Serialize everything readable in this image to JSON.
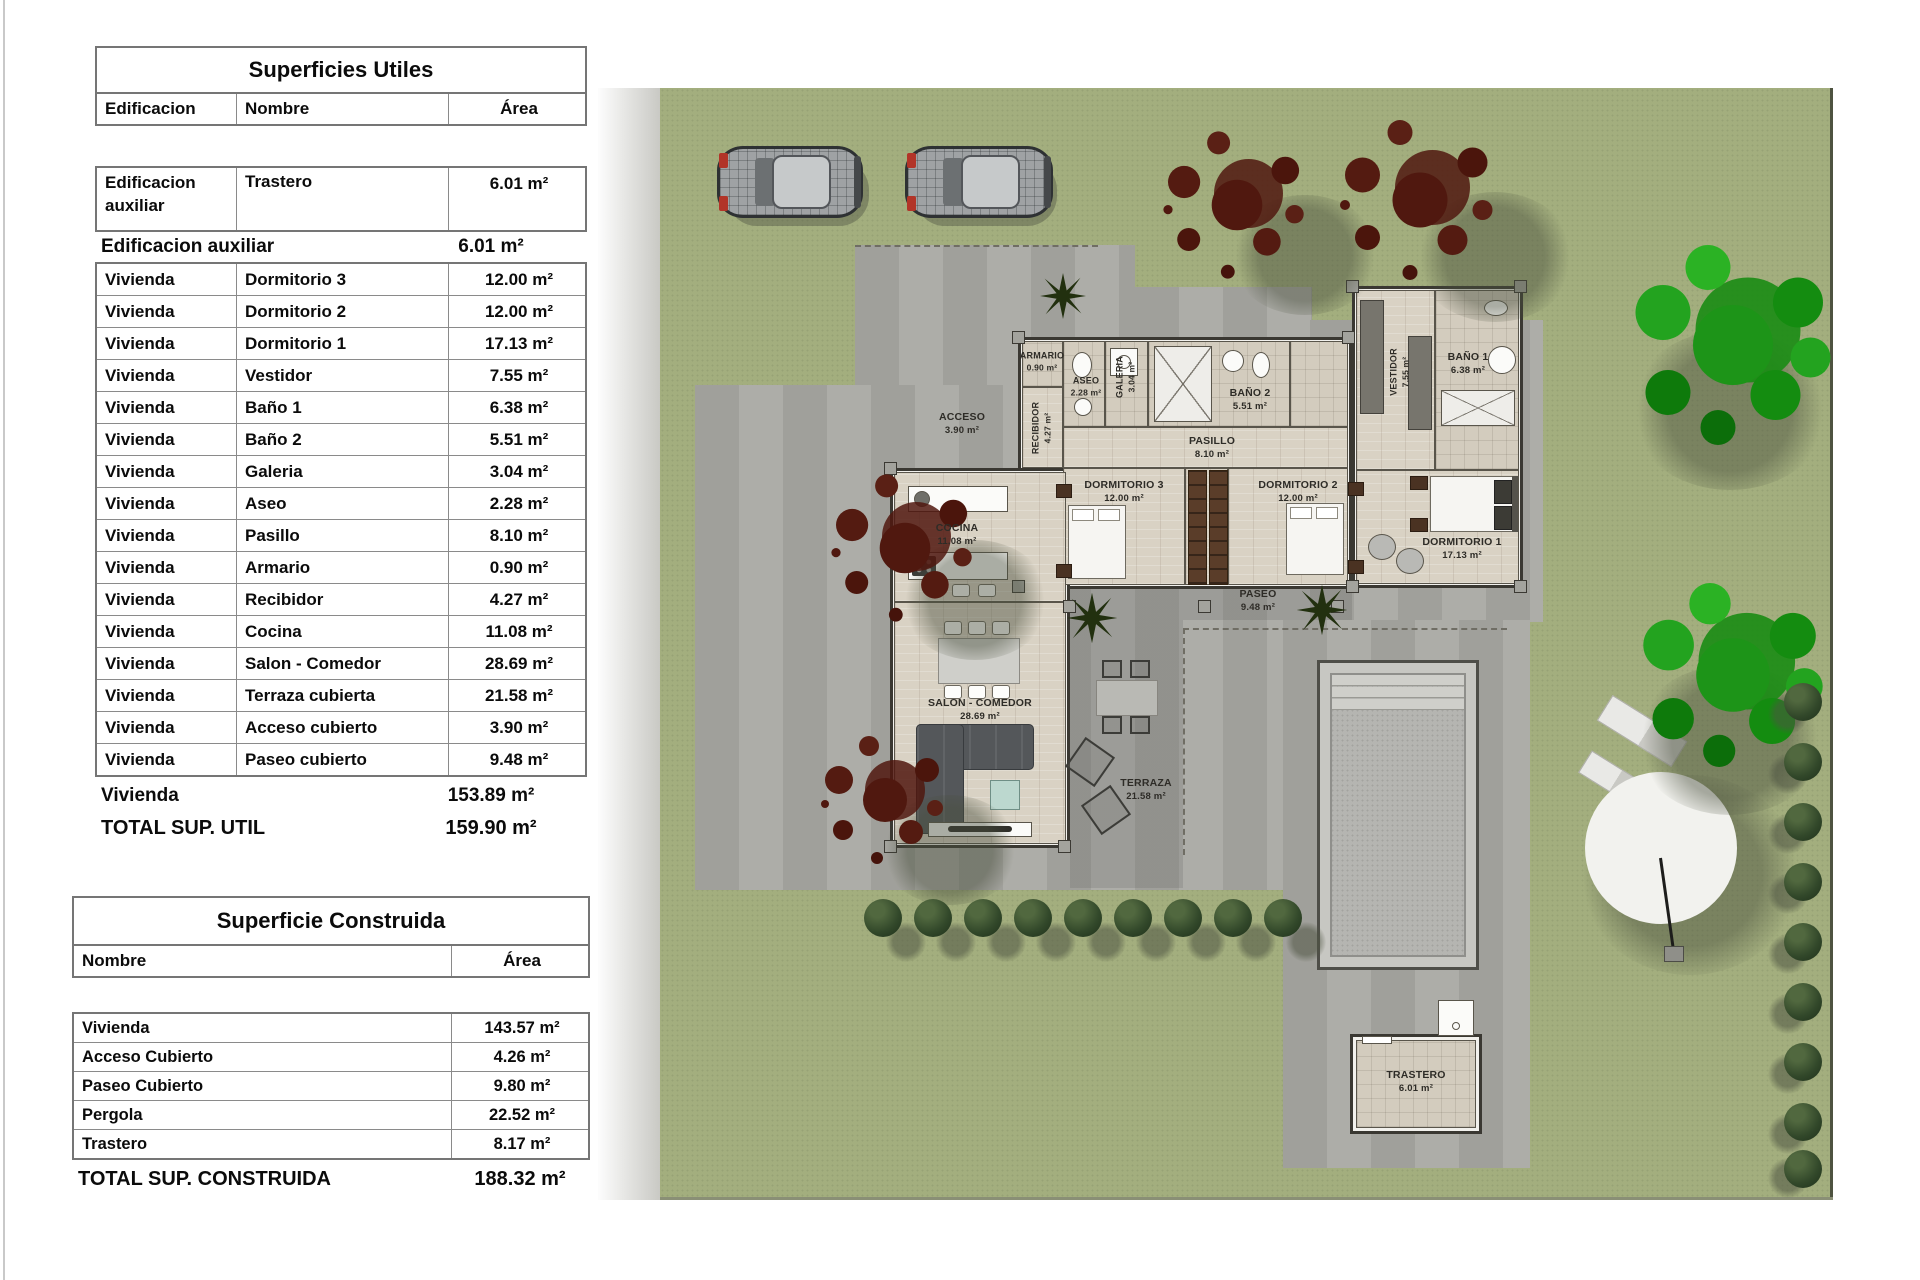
{
  "tables": {
    "useful": {
      "title": "Superficies Utiles",
      "columns": {
        "c1": "Edificacion",
        "c2": "Nombre",
        "c3": "Área"
      },
      "first_row": {
        "b": "Edificacion auxiliar",
        "n": "Trastero",
        "a": "6.01 m²"
      },
      "subtotal_aux": {
        "label": "Edificacion auxiliar",
        "value": "6.01 m²"
      },
      "rows": [
        {
          "b": "Vivienda",
          "n": "Dormitorio 3",
          "a": "12.00 m²"
        },
        {
          "b": "Vivienda",
          "n": "Dormitorio 2",
          "a": "12.00 m²"
        },
        {
          "b": "Vivienda",
          "n": "Dormitorio 1",
          "a": "17.13 m²"
        },
        {
          "b": "Vivienda",
          "n": "Vestidor",
          "a": "7.55 m²"
        },
        {
          "b": "Vivienda",
          "n": "Baño 1",
          "a": "6.38 m²"
        },
        {
          "b": "Vivienda",
          "n": "Baño 2",
          "a": "5.51 m²"
        },
        {
          "b": "Vivienda",
          "n": "Galeria",
          "a": "3.04 m²"
        },
        {
          "b": "Vivienda",
          "n": "Aseo",
          "a": "2.28 m²"
        },
        {
          "b": "Vivienda",
          "n": "Pasillo",
          "a": "8.10 m²"
        },
        {
          "b": "Vivienda",
          "n": "Armario",
          "a": "0.90 m²"
        },
        {
          "b": "Vivienda",
          "n": "Recibidor",
          "a": "4.27 m²"
        },
        {
          "b": "Vivienda",
          "n": "Cocina",
          "a": "11.08 m²"
        },
        {
          "b": "Vivienda",
          "n": "Salon - Comedor",
          "a": "28.69 m²"
        },
        {
          "b": "Vivienda",
          "n": "Terraza cubierta",
          "a": "21.58 m²"
        },
        {
          "b": "Vivienda",
          "n": "Acceso cubierto",
          "a": "3.90 m²"
        },
        {
          "b": "Vivienda",
          "n": "Paseo cubierto",
          "a": "9.48 m²"
        }
      ],
      "subtotal_viv": {
        "label": "Vivienda",
        "value": "153.89 m²"
      },
      "total": {
        "label": "TOTAL SUP. UTIL",
        "value": "159.90 m²"
      }
    },
    "built": {
      "title": "Superficie Construida",
      "columns": {
        "c1": "Nombre",
        "c2": "Área"
      },
      "rows": [
        {
          "n": "Vivienda",
          "a": "143.57 m²"
        },
        {
          "n": "Acceso Cubierto",
          "a": "4.26 m²"
        },
        {
          "n": "Paseo Cubierto",
          "a": "9.80 m²"
        },
        {
          "n": "Pergola",
          "a": "22.52 m²"
        },
        {
          "n": "Trastero",
          "a": "8.17 m²"
        }
      ],
      "total": {
        "label": "TOTAL SUP. CONSTRUIDA",
        "value": "188.32 m²"
      }
    }
  },
  "plan": {
    "rooms": [
      {
        "name": "ACCESO",
        "area": "3.90 m²"
      },
      {
        "name": "RECIBIDOR",
        "area": "4.27 m²"
      },
      {
        "name": "ARMARIO",
        "area": "0.90 m²"
      },
      {
        "name": "ASEO",
        "area": "2.28 m²"
      },
      {
        "name": "GALERIA",
        "area": "3.04 m²"
      },
      {
        "name": "BAÑO 2",
        "area": "5.51 m²"
      },
      {
        "name": "PASILLO",
        "area": "8.10 m²"
      },
      {
        "name": "DORMITORIO 3",
        "area": "12.00 m²"
      },
      {
        "name": "DORMITORIO 2",
        "area": "12.00 m²"
      },
      {
        "name": "PASEO",
        "area": "9.48 m²"
      },
      {
        "name": "VESTIDOR",
        "area": "7.55 m²"
      },
      {
        "name": "BAÑO 1",
        "area": "6.38 m²"
      },
      {
        "name": "DORMITORIO 1",
        "area": "17.13 m²"
      },
      {
        "name": "COCINA",
        "area": "11.08 m²"
      },
      {
        "name": "SALON - COMEDOR",
        "area": "28.69 m²"
      },
      {
        "name": "TERRAZA",
        "area": "21.58 m²"
      },
      {
        "name": "TRASTERO",
        "area": "6.01 m²"
      }
    ],
    "colors": {
      "grass": "#a3ae7e",
      "paved": "#a9a9a3",
      "wood_floor": "#d9d2c4",
      "tree_red": "#50180f",
      "tree_green": "#1d9418",
      "accent_red": "#b23428"
    }
  }
}
